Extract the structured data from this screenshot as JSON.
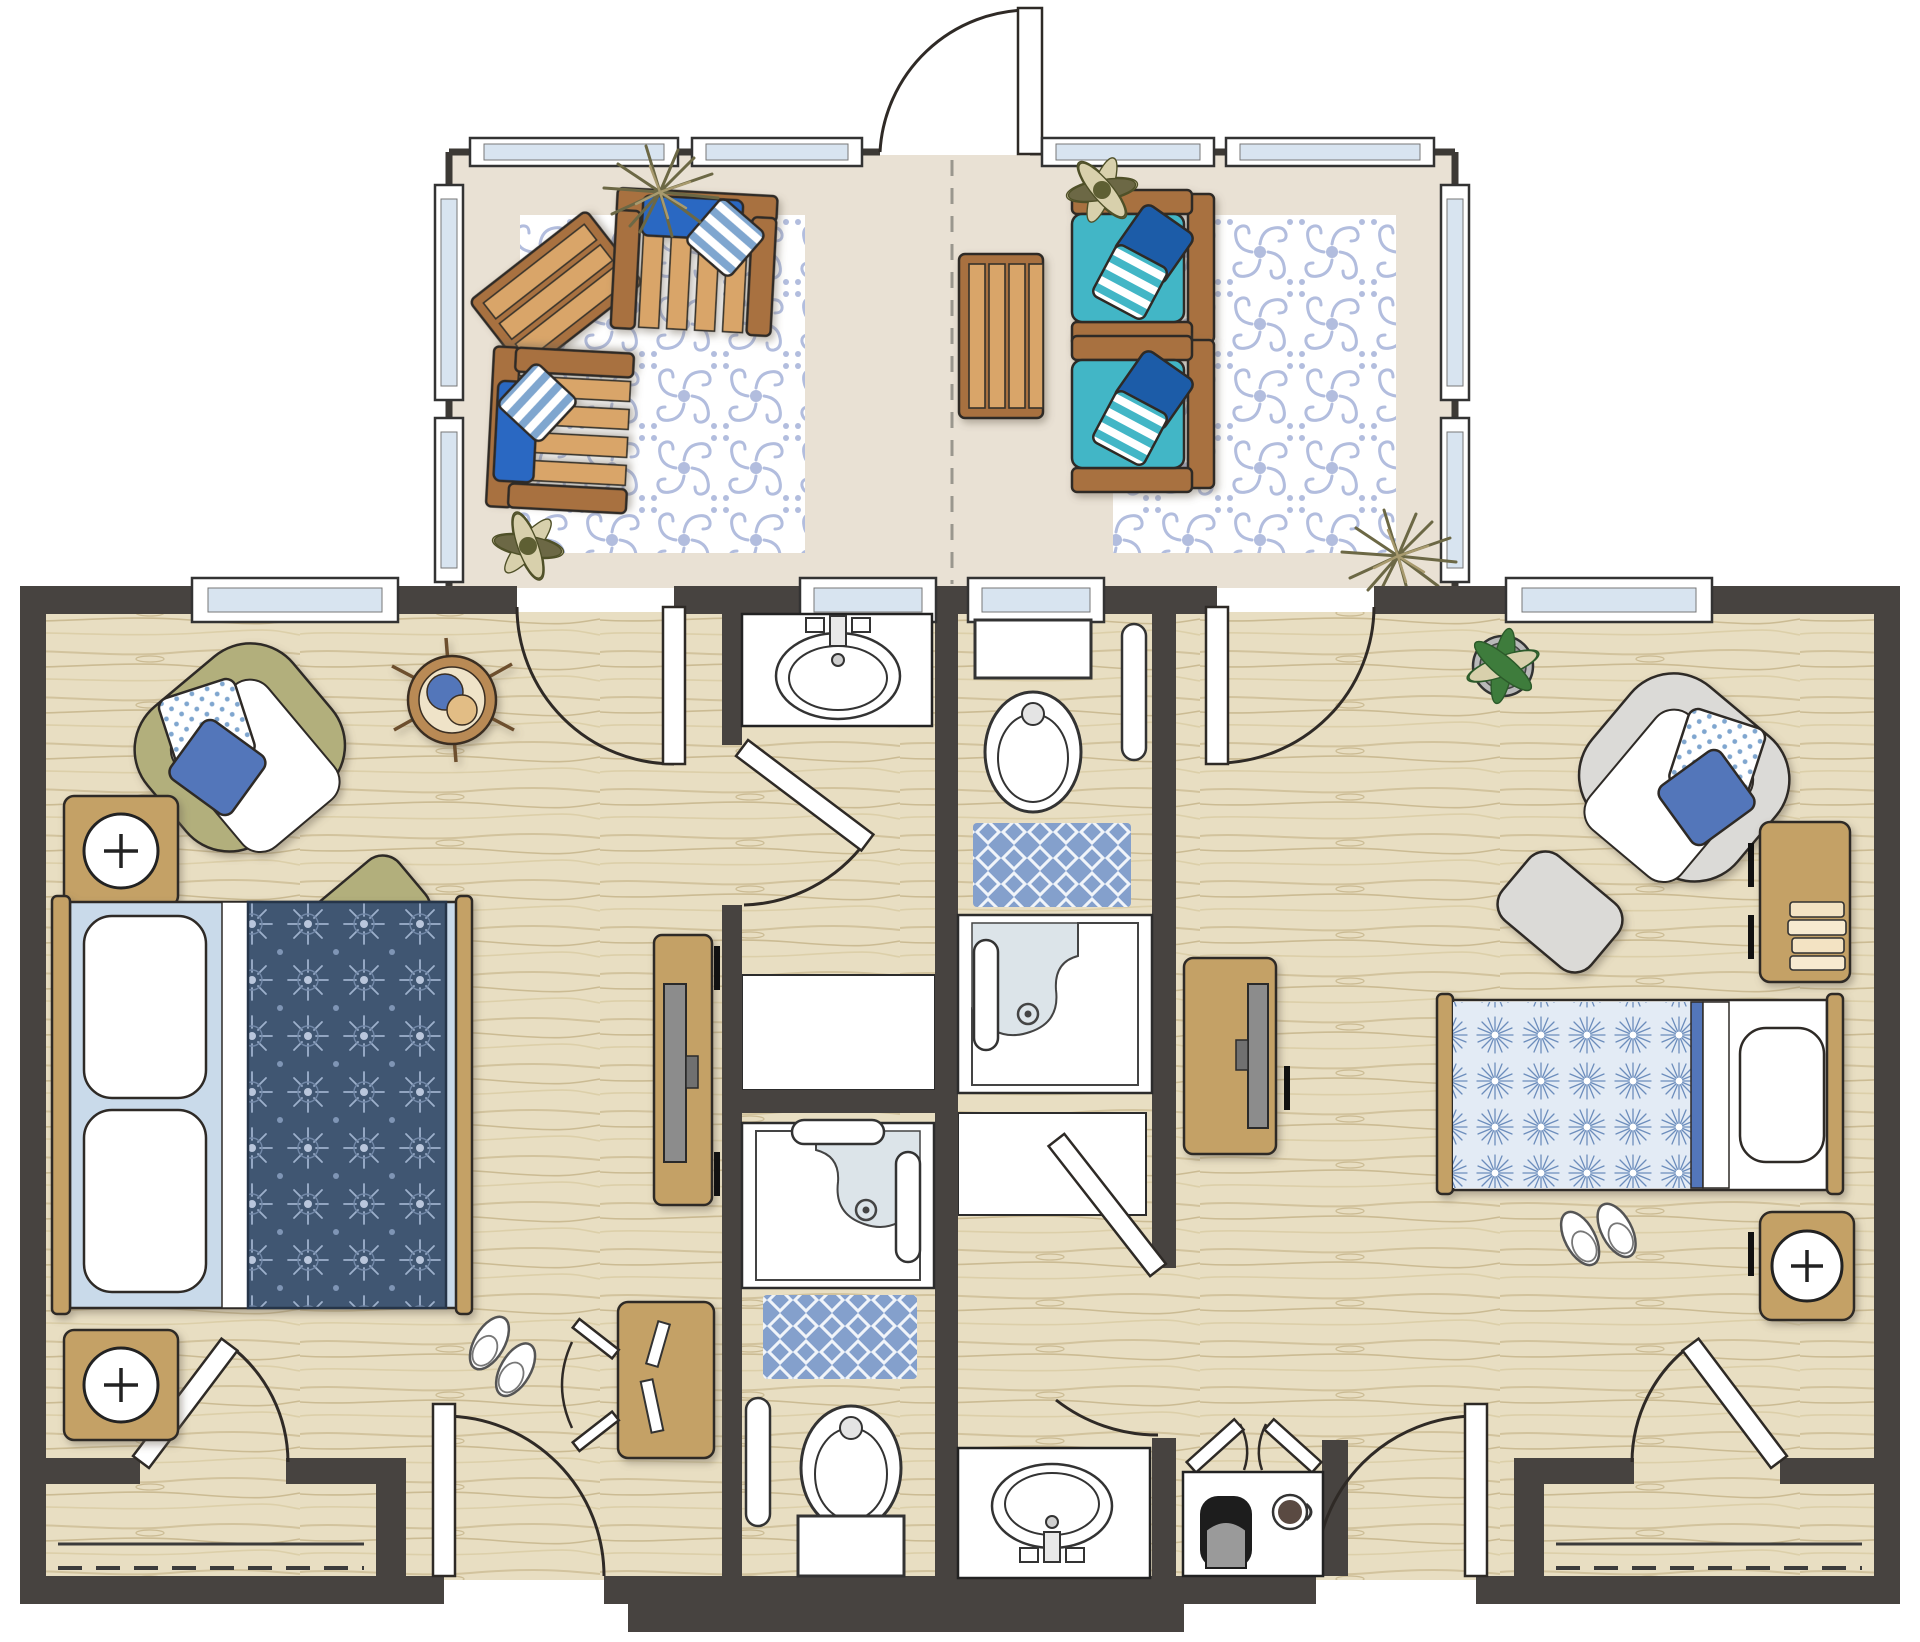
{
  "canvas": {
    "width": 1920,
    "height": 1642
  },
  "drawing": {
    "type": "floor-plan",
    "units": 2,
    "shared_patio": true,
    "text_labels": []
  },
  "palette": {
    "wall": "#474340",
    "wallthin": "#3c3935",
    "wood": "#e8dec2",
    "grain": "#d2c39d",
    "patio": "#e9e1d4",
    "rugblue": "#a9b6da",
    "matblue": "#84a0cc",
    "navy": "#415772",
    "navymotif": "#9db0cc",
    "litebedbg": "#e3ebf5",
    "litebedmotif": "#6c8dbc",
    "teal": "#43b6c6",
    "cushblue": "#2a67c2",
    "pillownavy": "#1e5ca8",
    "pillowblue": "#5276ba",
    "stripeblue": "#7fa6cf",
    "brown": "#a8713f",
    "tanlight": "#d9a569",
    "tan": "#c4a166",
    "olive": "#b2af7b",
    "graychair": "#dbdad7",
    "shower": "#dce4e9",
    "glass": "#d8e4f0",
    "leafgreen": "#3e7c3c",
    "leafcream": "#d8d0ac",
    "spiky": "#6c6845",
    "sheet": "#c9daea"
  }
}
